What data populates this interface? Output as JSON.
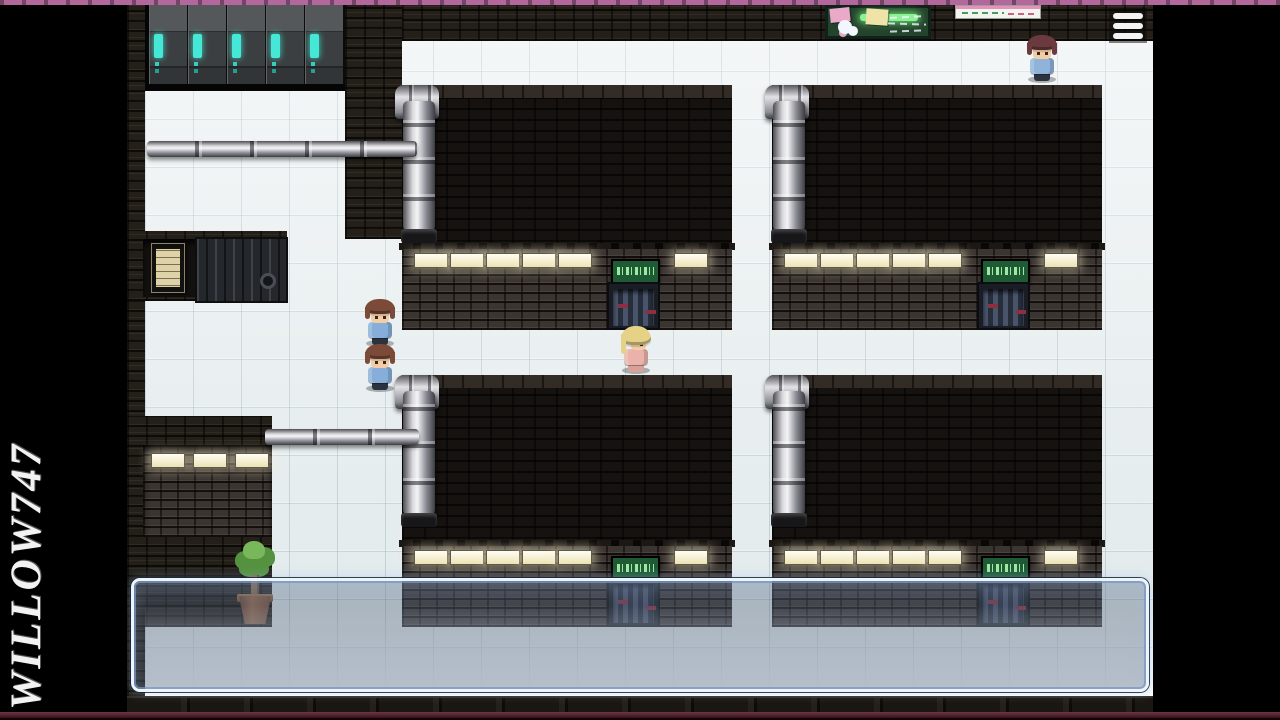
{
  "watermark": {
    "text": "WILLOW747"
  },
  "menu": {
    "icon": "hamburger-menu-icon",
    "bar_color": "#f4f4f4"
  },
  "frame": {
    "top_stripe_color": "#b2689c",
    "bottom_stripe_color": "#5a1c2c",
    "letterbox_color": "#000000"
  },
  "dialog_box": {
    "text": "",
    "state": "open-empty",
    "border_color": "#edf5fb",
    "fill_tint": "rgba(82,96,120,0.38)"
  },
  "map": {
    "floor_color": "#e6eced",
    "accent_cyan": "#45e8d6",
    "sign_bg": "#1e5a34",
    "sign_border": "#0e2a18",
    "sign_glyph_color": "#9fe8a0",
    "lamp_color": "#fbf6dd",
    "door_accent_red": "#8a3040",
    "paper_notice_color": "#ddd2a8"
  },
  "characters": [
    {
      "name": "npc-brown-hair-1",
      "facing": "down",
      "hair": "#7b4a38",
      "skin": "#f2cda6",
      "shirt": "#86aed8",
      "pants": "#2c3340"
    },
    {
      "name": "npc-brown-hair-2",
      "facing": "down",
      "hair": "#7b4a38",
      "skin": "#f2cda6",
      "shirt": "#86aed8",
      "pants": "#2c3340"
    },
    {
      "name": "npc-blonde",
      "facing": "right",
      "hair": "#e5d287",
      "skin": "#f2cda6",
      "shirt": "#e9b3ab",
      "pants": "#d8a098"
    },
    {
      "name": "npc-dark-red-hair",
      "facing": "down",
      "hair": "#6b3a3e",
      "skin": "#f2cda6",
      "shirt": "#8fb3d9",
      "pants": "#2c3340"
    }
  ],
  "props": {
    "bulletin_board": {
      "bg": "#24432c",
      "chalk_green": "#8df294",
      "note_pink": "#eaa9c9",
      "note_yellow": "#f0e3a8"
    },
    "whiteboard_poster": {
      "bg": "#f2f5ef",
      "stripe": "#e592ba",
      "scribble_green": "#4a9a5a",
      "scribble_pink": "#d06080"
    },
    "potted_plant": {
      "leaf": "#54923f",
      "leaf_light": "#79b85a",
      "pot": "#8a5a40"
    },
    "server_rack_count": 5,
    "door_count": 4
  }
}
